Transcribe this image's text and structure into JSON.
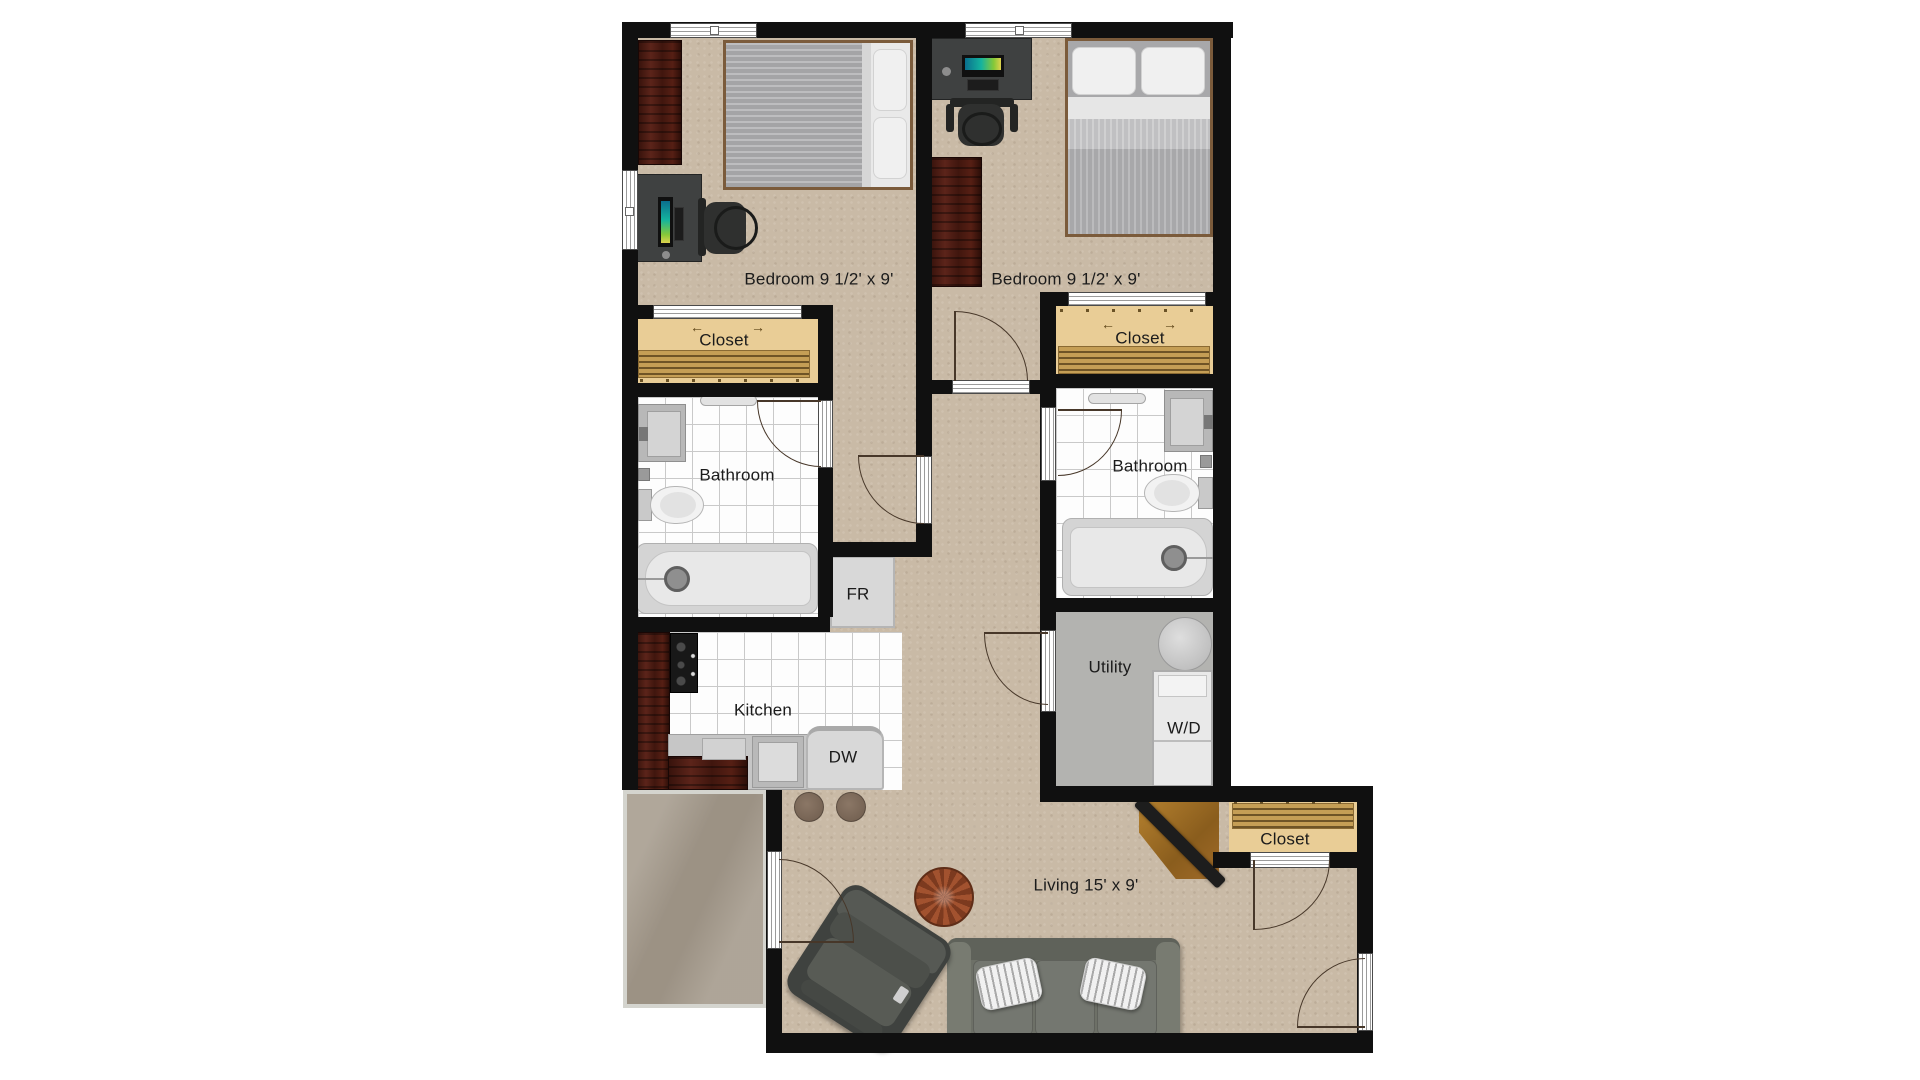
{
  "plan": {
    "rooms": {
      "bedroom_left": {
        "label": "Bedroom 9 1/2' x 9'"
      },
      "bedroom_right": {
        "label": "Bedroom 9 1/2' x 9'"
      },
      "closet_left": {
        "label": "Closet"
      },
      "closet_right": {
        "label": "Closet"
      },
      "closet_entry": {
        "label": "Closet"
      },
      "bathroom_left": {
        "label": "Bathroom"
      },
      "bathroom_right": {
        "label": "Bathroom"
      },
      "kitchen": {
        "label": "Kitchen"
      },
      "utility": {
        "label": "Utility"
      },
      "living": {
        "label": "Living 15' x 9'"
      }
    },
    "appliances": {
      "dishwasher": "DW",
      "fridge": "FR",
      "washer_dryer": "W/D"
    },
    "glyphs": {
      "slide_left": "←",
      "slide_right": "→"
    },
    "colors": {
      "wall": "#101010",
      "floor_tan": "#c9baa6",
      "floor_tile": "#fdfdfd",
      "tile_grout": "#c9c9c9",
      "closet_floor": "#e9cd96",
      "closet_shelf": "#c59e55",
      "utility_floor": "#b3b3b0",
      "patio": "#a79d8f",
      "door_arc": "#473729",
      "label_text": "#1b1b1b",
      "wood_dresser": "#4a1d15",
      "monitor_screen_accent": "#14b39e"
    }
  }
}
